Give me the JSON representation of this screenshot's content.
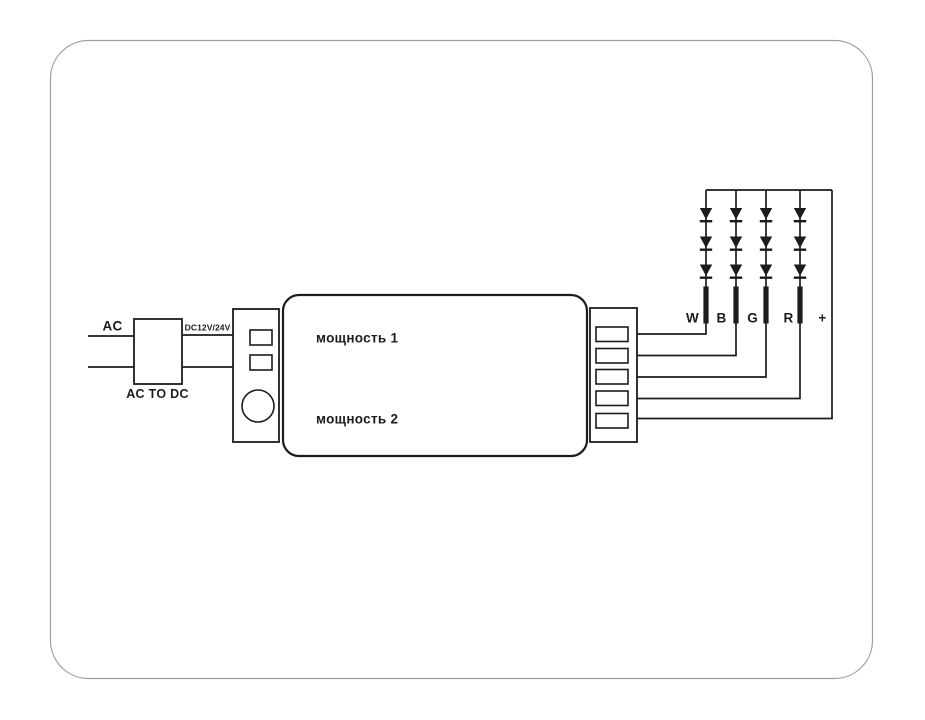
{
  "diagram": {
    "power_input": {
      "ac_label": "AC",
      "converter_label": "AC TO DC",
      "output_voltage_label": "DC12V/24V"
    },
    "controller": {
      "channel1_label": "мощность 1",
      "channel2_label": "мощность 2"
    },
    "led_channels": {
      "w": "W",
      "b": "B",
      "g": "G",
      "r": "R",
      "plus": "+"
    },
    "colors": {
      "line": "#1c1c1c",
      "frame_border": "#9e9e9e",
      "background": "#ffffff"
    }
  }
}
